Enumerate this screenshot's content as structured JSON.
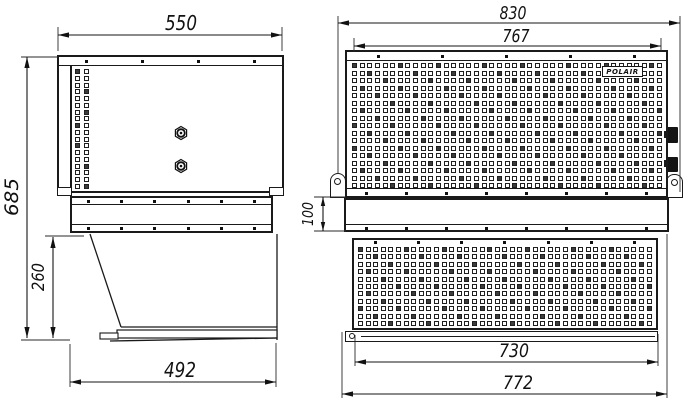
{
  "logo": {
    "brand": "POLAIR"
  },
  "dimensions": {
    "side_view": {
      "top_width": "550",
      "overall_height": "685",
      "duct_height": "260",
      "bottom_width": "492"
    },
    "front_view": {
      "overall_width": "830",
      "grille_width": "767",
      "spacer_height": "100",
      "lower_grille_width": "730",
      "lower_width": "772"
    }
  }
}
